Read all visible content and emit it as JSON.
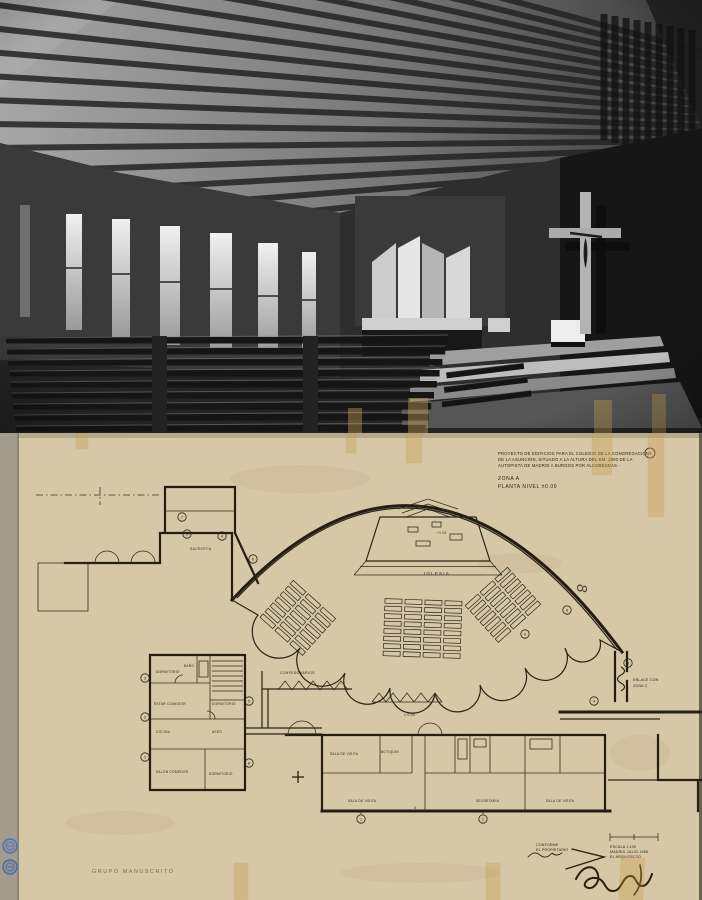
{
  "photo": {
    "alt": "Interior de la capilla: techo de vigas de hormigon, ventanales laterales, organo, crucifijo y bancos"
  },
  "plan": {
    "title": {
      "line1": "PROYECTO DE EDIFICIOS PARA EL COLEGIO DE LA CONGREGACION",
      "line2": "DE LA ASUNCION, SITUADO A LA ALTURA DEL KM. 1900 DE LA",
      "line3": "AUTOPISTA DE MADRID A BURGOS POR ALCOBENDAS.-",
      "zona": "ZONA A",
      "planta": "PLANTA NIVEL ±0.00",
      "sheet_no": "4"
    },
    "labels": {
      "iglesia": "IGLESIA",
      "altar_level": "+1.05",
      "nave_level": "± 0.00",
      "confesonarios": "CONFESONARIOS",
      "sacristia": "SACRISTIA",
      "enlace_1": "ENLACE CON",
      "enlace_2": "ZONA C",
      "dormitorio_a": "DORMITORIO",
      "bano": "BAÑO",
      "estar_comedor": "ESTAR COMEDOR",
      "dormitorio_b": "DORMITORIO",
      "cocina": "COCINA",
      "aseo": "ASEO",
      "salon_comedor": "SALON COMEDOR",
      "dormitorio_c": "DORMITORIO",
      "sala_visita_1": "SALA DE VISITA",
      "botiquin": "BOTIQUIN",
      "sala_visita_2": "SALA DE VISITA",
      "secretaria": "SECRETARIA",
      "sala_visita_3": "SALA DE VISITA",
      "axis_ii": "II"
    },
    "rings": [
      "7",
      "5",
      "4",
      "6",
      "3",
      "2",
      "1",
      "5",
      "6",
      "9",
      "8",
      "3",
      "1",
      "2",
      "4"
    ],
    "sign_block": {
      "conforme": "CONFORME",
      "propietario": "EL PROPIETARIO",
      "escala": "ESCALA 1:100",
      "fecha": "MADRID-JULIO-1966",
      "arquitecto": "EL ARQUITECTO"
    },
    "pencil": {
      "numeral": "8",
      "note": "GRUPO MANUSCRITO"
    }
  }
}
